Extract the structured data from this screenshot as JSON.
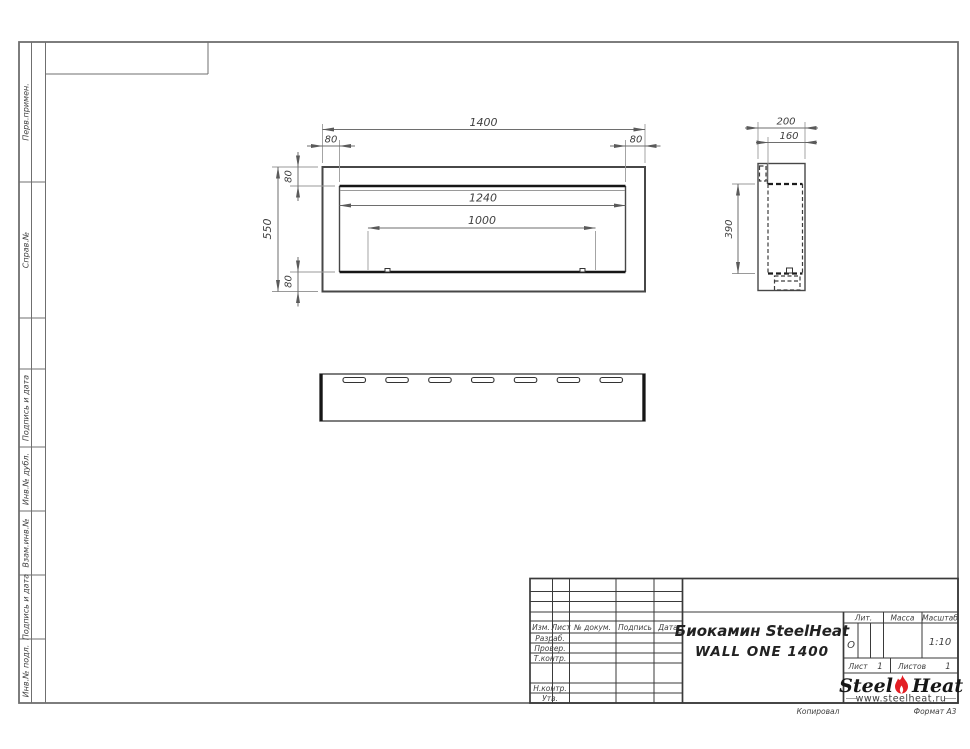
{
  "sidebar": {
    "labels": [
      "Перв.примен.",
      "Справ.№",
      "Подпись и дата",
      "Инв.№ дубл.",
      "Взам.инв.№",
      "Подпись и дата",
      "Инв.№ подл."
    ]
  },
  "front_view": {
    "dim_total_width": "1400",
    "dim_left_offset": "80",
    "dim_right_offset": "80",
    "dim_height": "550",
    "dim_top_offset": "80",
    "dim_bottom_offset": "80",
    "dim_opening_width": "1240",
    "dim_burner_width": "1000"
  },
  "side_view": {
    "dim_depth": "200",
    "dim_inner_depth": "160",
    "dim_height": "390"
  },
  "title_block": {
    "header_columns": [
      "Изм.",
      "Лист",
      "№ докум.",
      "Подпись",
      "Дата"
    ],
    "row_labels": [
      "Разраб.",
      "Провер.",
      "Т.контр.",
      "Н.контр.",
      "Утв."
    ],
    "title_line1": "Биокамин SteelHeat",
    "title_line2": "WALL ONE 1400",
    "lit_label": "Лит.",
    "lit_value": "О",
    "mass_label": "Масса",
    "scale_label": "Масштаб",
    "scale_value": "1:10",
    "sheet_label": "Лист",
    "sheet_number": "1",
    "sheets_label": "Листов",
    "sheets_total": "1"
  },
  "logo": {
    "word1": "Steel",
    "word2": "Heat",
    "website": "www.steelheat.ru",
    "flame_color": "#e31e24"
  },
  "footer": {
    "left": "Копировал",
    "right": "Формат А3"
  }
}
